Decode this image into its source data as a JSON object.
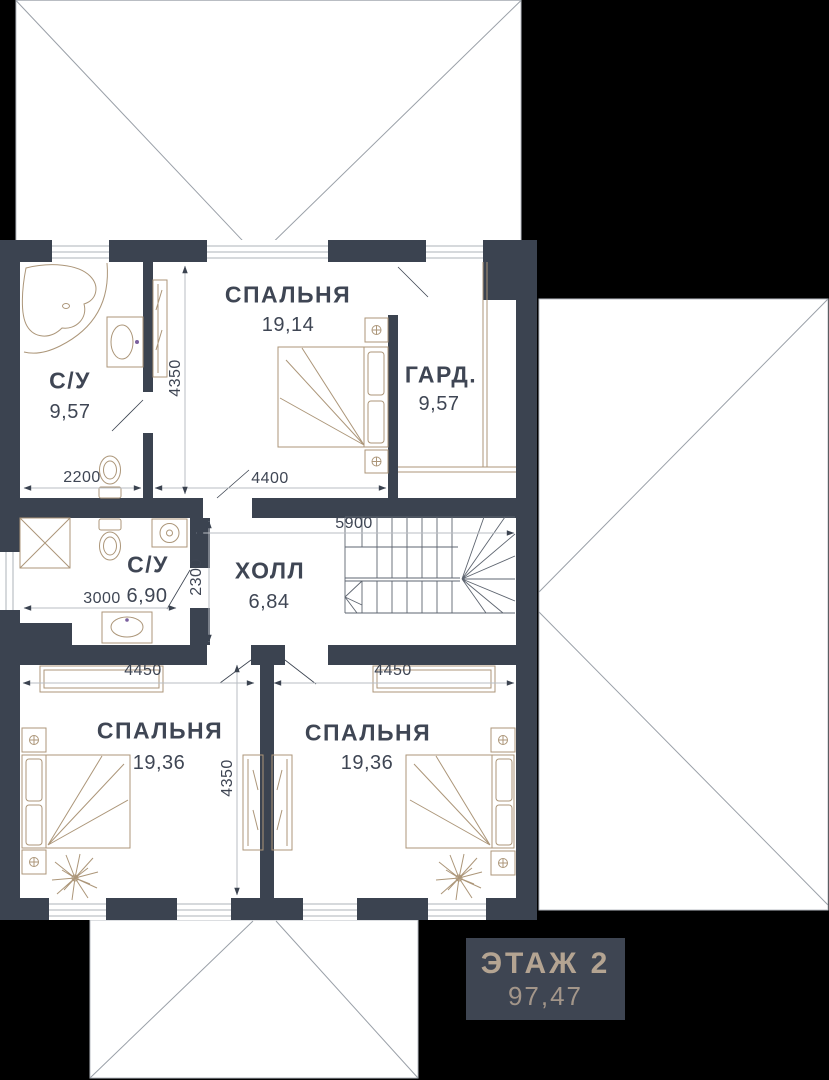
{
  "floor_badge": {
    "title": "ЭТАЖ 2",
    "total_area": "97,47"
  },
  "rooms": {
    "bath1": {
      "name": "С/У",
      "area": "9,57"
    },
    "bedroom1": {
      "name": "СПАЛЬНЯ",
      "area": "19,14"
    },
    "wardrobe": {
      "name": "ГАРД.",
      "area": "9,57"
    },
    "bath2": {
      "name": "С/У",
      "area": "6,90"
    },
    "hall": {
      "name": "ХОЛЛ",
      "area": "6,84"
    },
    "bedroom2": {
      "name": "СПАЛЬНЯ",
      "area": "19,36"
    },
    "bedroom3": {
      "name": "СПАЛЬНЯ",
      "area": "19,36"
    }
  },
  "dimensions": {
    "bath1_width": "2200",
    "bedroom1_width": "4400",
    "upper_depth": "4350",
    "bath2_width": "3000",
    "hall_width": "5900",
    "hall_depth": "2300",
    "bedroom2_width": "4450",
    "bedroom3_width": "4450",
    "lower_depth": "4350"
  },
  "icons": [
    "bathtub-icon",
    "sink-icon",
    "toilet-icon",
    "shower-cabin-icon",
    "washing-machine-icon",
    "vanity-sink-icon",
    "bed-icon",
    "nightstand-icon",
    "flower-icon",
    "plant-icon",
    "wardrobe-icon",
    "stairs-icon",
    "window-icon",
    "door-swing-icon",
    "roof-outline-icon"
  ],
  "colors": {
    "background": "#000000",
    "plan_floor": "#ffffff",
    "walls": "#3b4350",
    "text": "#3f4654",
    "furniture_outline": "#ac9679",
    "dimension_line": "#c6c9cd",
    "roof_line": "#9aa0a8",
    "badge_bg": "#3e4552",
    "badge_text": "#b4a492"
  }
}
